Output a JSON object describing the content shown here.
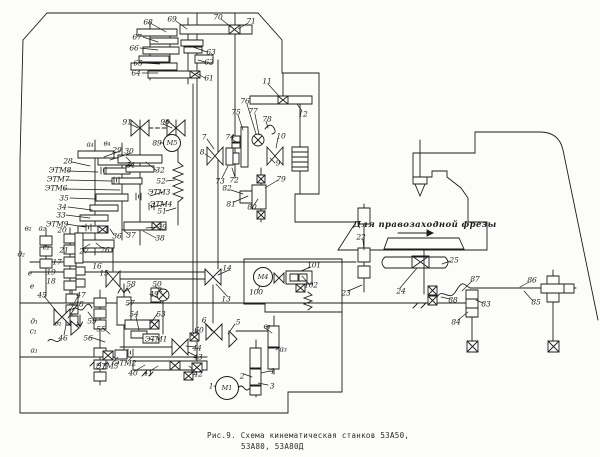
{
  "figure": {
    "caption_line1": "Рис.9. Схема кинематическая станков 53А50,",
    "caption_line2": "53А80, 53А80Д",
    "annotation": "Для правозаходной фрезы"
  },
  "colors": {
    "ink": "#1c1c1c",
    "paper": "#fcfcfa"
  },
  "motors": [
    {
      "label": "М1",
      "x": 227,
      "y": 388,
      "r": 11
    },
    {
      "label": "М4",
      "x": 263,
      "y": 277,
      "r": 9
    },
    {
      "label": "М5",
      "x": 172,
      "y": 143,
      "r": 8
    }
  ],
  "part_labels": [
    {
      "t": "68",
      "x": 148,
      "y": 22
    },
    {
      "t": "67",
      "x": 137,
      "y": 37
    },
    {
      "t": "66",
      "x": 134,
      "y": 48
    },
    {
      "t": "65",
      "x": 138,
      "y": 63
    },
    {
      "t": "64",
      "x": 136,
      "y": 73
    },
    {
      "t": "69",
      "x": 172,
      "y": 19
    },
    {
      "t": "70",
      "x": 218,
      "y": 17
    },
    {
      "t": "71",
      "x": 251,
      "y": 21
    },
    {
      "t": "63",
      "x": 211,
      "y": 52
    },
    {
      "t": "62",
      "x": 209,
      "y": 62
    },
    {
      "t": "61",
      "x": 209,
      "y": 78
    },
    {
      "t": "11",
      "x": 267,
      "y": 81
    },
    {
      "t": "12",
      "x": 303,
      "y": 114
    },
    {
      "t": "76",
      "x": 245,
      "y": 101
    },
    {
      "t": "77",
      "x": 253,
      "y": 111
    },
    {
      "t": "78",
      "x": 267,
      "y": 119
    },
    {
      "t": "75",
      "x": 236,
      "y": 112
    },
    {
      "t": "74",
      "x": 230,
      "y": 137
    },
    {
      "t": "7",
      "x": 204,
      "y": 137
    },
    {
      "t": "8",
      "x": 202,
      "y": 152
    },
    {
      "t": "10",
      "x": 281,
      "y": 136
    },
    {
      "t": "9",
      "x": 278,
      "y": 163
    },
    {
      "t": "73",
      "x": 220,
      "y": 181
    },
    {
      "t": "72",
      "x": 234,
      "y": 180
    },
    {
      "t": "82",
      "x": 227,
      "y": 188
    },
    {
      "t": "81",
      "x": 231,
      "y": 204
    },
    {
      "t": "80",
      "x": 252,
      "y": 207
    },
    {
      "t": "79",
      "x": 281,
      "y": 179
    },
    {
      "t": "91",
      "x": 127,
      "y": 122
    },
    {
      "t": "90",
      "x": 165,
      "y": 122
    },
    {
      "t": "89",
      "x": 157,
      "y": 143
    },
    {
      "t": "а₄",
      "x": 90,
      "y": 144
    },
    {
      "t": "в₄",
      "x": 107,
      "y": 143
    },
    {
      "t": "29",
      "x": 117,
      "y": 150
    },
    {
      "t": "30",
      "x": 129,
      "y": 151
    },
    {
      "t": "28",
      "x": 68,
      "y": 161
    },
    {
      "t": "ЭТМ8",
      "x": 60,
      "y": 170
    },
    {
      "t": "ЭТМ7",
      "x": 58,
      "y": 179
    },
    {
      "t": "ЭТМ6",
      "x": 56,
      "y": 188
    },
    {
      "t": "35",
      "x": 64,
      "y": 198
    },
    {
      "t": "34",
      "x": 62,
      "y": 207
    },
    {
      "t": "33",
      "x": 61,
      "y": 215
    },
    {
      "t": "ЭТМ9",
      "x": 57,
      "y": 224
    },
    {
      "t": "20",
      "x": 62,
      "y": 230
    },
    {
      "t": "31",
      "x": 131,
      "y": 165
    },
    {
      "t": "32",
      "x": 160,
      "y": 170
    },
    {
      "t": "52",
      "x": 161,
      "y": 181
    },
    {
      "t": "ЭТМ3",
      "x": 159,
      "y": 192
    },
    {
      "t": "ЭТМ4",
      "x": 161,
      "y": 204
    },
    {
      "t": "51",
      "x": 162,
      "y": 211
    },
    {
      "t": "39",
      "x": 162,
      "y": 227
    },
    {
      "t": "38",
      "x": 160,
      "y": 238
    },
    {
      "t": "37",
      "x": 131,
      "y": 235
    },
    {
      "t": "36",
      "x": 117,
      "y": 236
    },
    {
      "t": "27",
      "x": 84,
      "y": 251
    },
    {
      "t": "26",
      "x": 105,
      "y": 250
    },
    {
      "t": "в₂",
      "x": 28,
      "y": 228
    },
    {
      "t": "а₂",
      "x": 42,
      "y": 228
    },
    {
      "t": "с₂",
      "x": 46,
      "y": 247
    },
    {
      "t": "д₂",
      "x": 21,
      "y": 254
    },
    {
      "t": "21",
      "x": 64,
      "y": 250
    },
    {
      "t": "17",
      "x": 57,
      "y": 262
    },
    {
      "t": "19",
      "x": 51,
      "y": 272
    },
    {
      "t": "18",
      "x": 51,
      "y": 281
    },
    {
      "t": "е",
      "x": 30,
      "y": 273
    },
    {
      "t": "е",
      "x": 32,
      "y": 286
    },
    {
      "t": "16",
      "x": 97,
      "y": 266
    },
    {
      "t": "15",
      "x": 104,
      "y": 273
    },
    {
      "t": "45",
      "x": 42,
      "y": 295
    },
    {
      "t": "47",
      "x": 81,
      "y": 295
    },
    {
      "t": "48",
      "x": 79,
      "y": 304
    },
    {
      "t": "46",
      "x": 63,
      "y": 338
    },
    {
      "t": "д₁",
      "x": 34,
      "y": 321
    },
    {
      "t": "в₁",
      "x": 58,
      "y": 323
    },
    {
      "t": "с₁",
      "x": 33,
      "y": 331
    },
    {
      "t": "а₁",
      "x": 34,
      "y": 350
    },
    {
      "t": "59",
      "x": 92,
      "y": 321
    },
    {
      "t": "55",
      "x": 101,
      "y": 329
    },
    {
      "t": "56",
      "x": 88,
      "y": 338
    },
    {
      "t": "58",
      "x": 131,
      "y": 284
    },
    {
      "t": "57",
      "x": 130,
      "y": 303
    },
    {
      "t": "54",
      "x": 134,
      "y": 314
    },
    {
      "t": "53",
      "x": 161,
      "y": 314
    },
    {
      "t": "50",
      "x": 157,
      "y": 284
    },
    {
      "t": "49",
      "x": 154,
      "y": 294
    },
    {
      "t": "ЭТМ5",
      "x": 107,
      "y": 366
    },
    {
      "t": "ЭТМ2",
      "x": 125,
      "y": 363
    },
    {
      "t": "ЭТМ1",
      "x": 156,
      "y": 339
    },
    {
      "t": "40",
      "x": 133,
      "y": 373
    },
    {
      "t": "41",
      "x": 148,
      "y": 373
    },
    {
      "t": "42",
      "x": 198,
      "y": 374
    },
    {
      "t": "43",
      "x": 198,
      "y": 357
    },
    {
      "t": "44",
      "x": 197,
      "y": 348
    },
    {
      "t": "60",
      "x": 199,
      "y": 330
    },
    {
      "t": "6",
      "x": 204,
      "y": 320
    },
    {
      "t": "5",
      "x": 238,
      "y": 322
    },
    {
      "t": "14",
      "x": 227,
      "y": 268
    },
    {
      "t": "13",
      "x": 226,
      "y": 299
    },
    {
      "t": "в₃",
      "x": 267,
      "y": 326
    },
    {
      "t": "а₃",
      "x": 283,
      "y": 349
    },
    {
      "t": "4",
      "x": 272,
      "y": 371
    },
    {
      "t": "2",
      "x": 242,
      "y": 376
    },
    {
      "t": "3",
      "x": 272,
      "y": 386
    },
    {
      "t": "1",
      "x": 211,
      "y": 386
    },
    {
      "t": "100",
      "x": 256,
      "y": 292
    },
    {
      "t": "101",
      "x": 314,
      "y": 265
    },
    {
      "t": "102",
      "x": 311,
      "y": 285
    },
    {
      "t": "23",
      "x": 346,
      "y": 293
    },
    {
      "t": "24",
      "x": 401,
      "y": 291
    },
    {
      "t": "22",
      "x": 361,
      "y": 237
    },
    {
      "t": "25",
      "x": 454,
      "y": 260
    },
    {
      "t": "87",
      "x": 475,
      "y": 279
    },
    {
      "t": "88",
      "x": 453,
      "y": 300
    },
    {
      "t": "86",
      "x": 532,
      "y": 280
    },
    {
      "t": "85",
      "x": 536,
      "y": 302
    },
    {
      "t": "83",
      "x": 486,
      "y": 304
    },
    {
      "t": "84",
      "x": 456,
      "y": 322
    }
  ]
}
